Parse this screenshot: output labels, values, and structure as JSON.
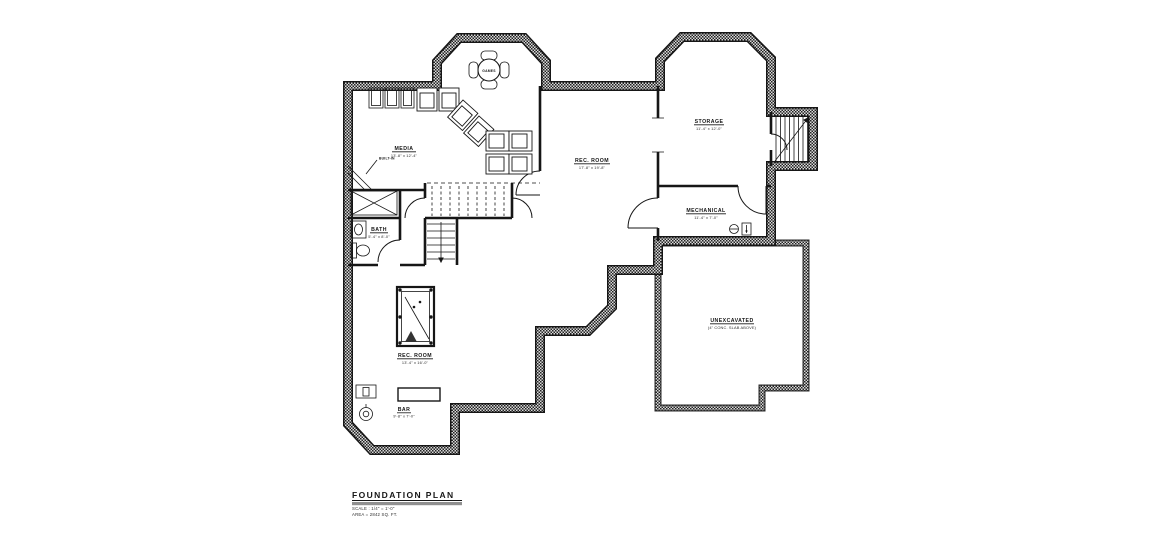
{
  "drawing": {
    "title_block": {
      "title": "FOUNDATION PLAN",
      "scale_note": "SCALE : 1/4\" = 1'-0\"",
      "area_note": "AREA = 2842 SQ. FT."
    },
    "rooms": {
      "games": {
        "name": "GAMES"
      },
      "media": {
        "name": "MEDIA",
        "dims": "13'-8\" x 12'-4\""
      },
      "rec_room_upper": {
        "name": "REC. ROOM",
        "dims": "17'-8\" x 19'-8\""
      },
      "storage": {
        "name": "STORAGE",
        "dims": "11'-4\" x 12'-0\""
      },
      "mechanical": {
        "name": "MECHANICAL",
        "dims": "11'-4\" x 7'-0\""
      },
      "unexcavated": {
        "name": "UNEXCAVATED",
        "note": "(4\" CONC. SLAB ABOVE)"
      },
      "bath": {
        "name": "BATH",
        "dims": "5'-4\" x 8'-0\""
      },
      "rec_room_lower": {
        "name": "REC. ROOM",
        "dims": "13'-4\" x 16'-0\""
      },
      "bar": {
        "name": "BAR",
        "dims": "9'-8\" x 7'-0\""
      }
    },
    "annotations": {
      "built_in": "BUILT-IN"
    }
  },
  "colors": {
    "line": "#161616",
    "wall_hatch_light": "#d9d9d9",
    "title_bar": "#909090",
    "background": "#ffffff"
  }
}
